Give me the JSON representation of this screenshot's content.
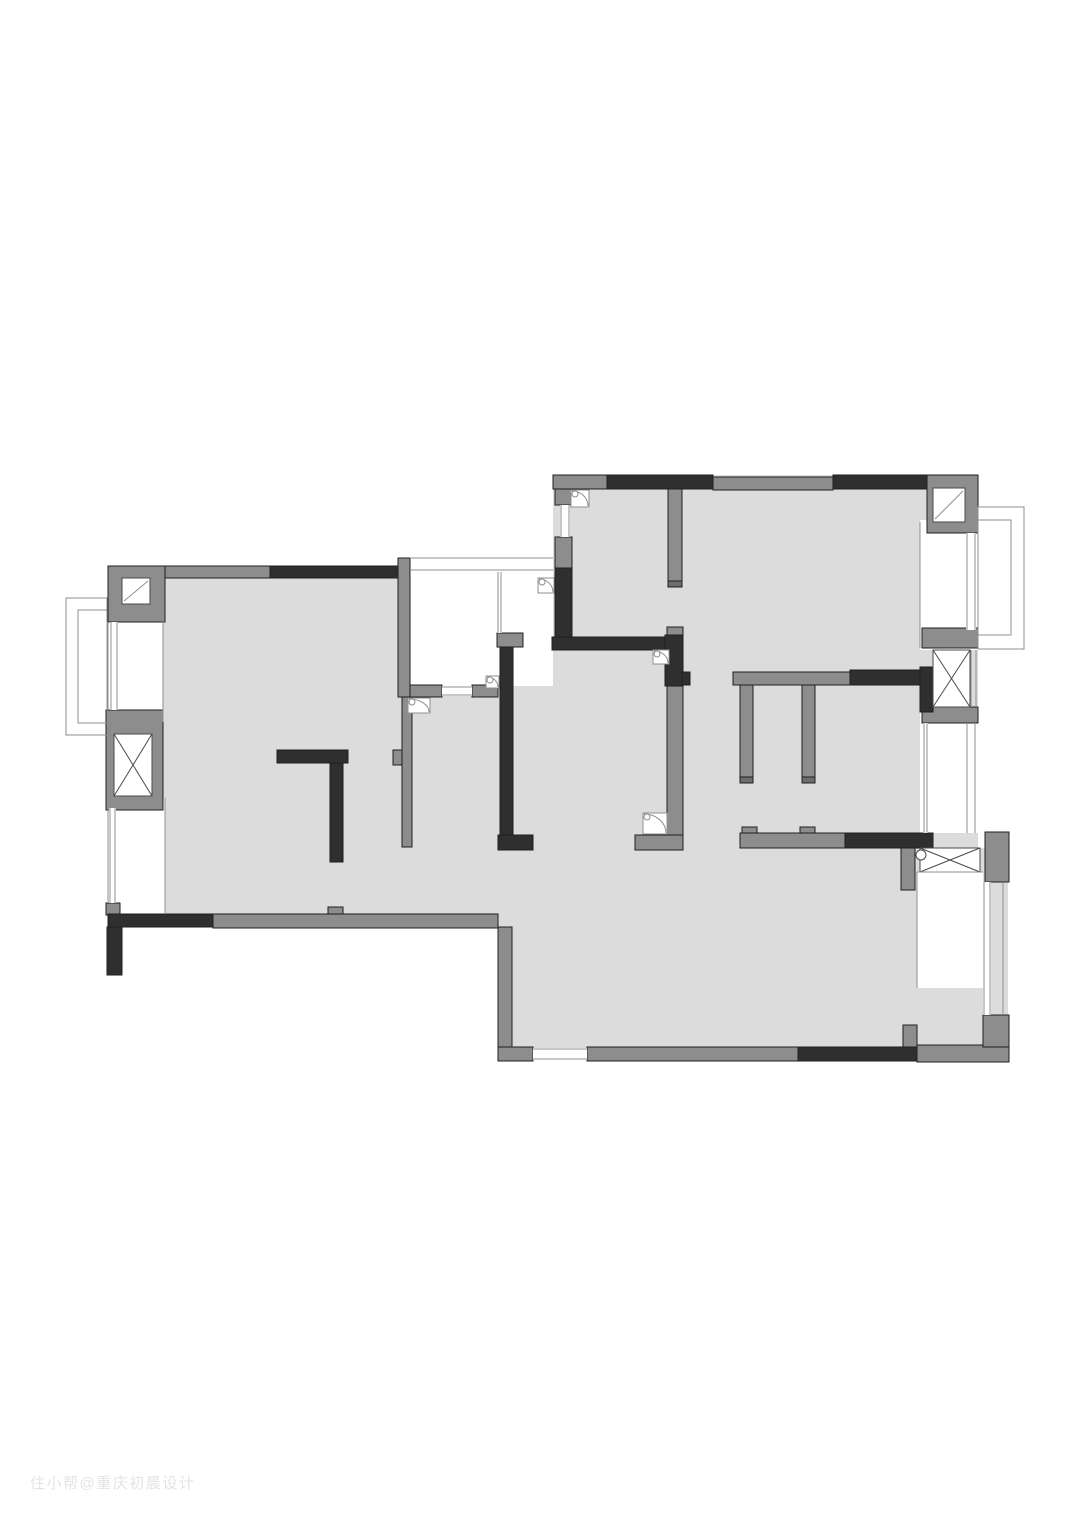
{
  "watermark": {
    "text": "住小帮@重庆初晨设计"
  },
  "plan": {
    "palette": {
      "floor": "#dcdcdd",
      "wall_gray": "#8d8d8d",
      "wall_dark": "#2f2f2f",
      "wall_cap": "#6d6d6d",
      "outline": "#1f1f1f",
      "thin": "#8f8f8f",
      "hatch": "#4a4a4a"
    },
    "floors": [
      [
        163,
        578,
        239,
        336
      ],
      [
        402,
        685,
        151,
        243
      ],
      [
        553,
        475,
        425,
        373
      ],
      [
        498,
        848,
        510,
        212
      ]
    ],
    "white_areas": [
      [
        410,
        556,
        143,
        130
      ],
      [
        108,
        600,
        55,
        122
      ],
      [
        108,
        798,
        57,
        118
      ],
      [
        920,
        520,
        58,
        130
      ],
      [
        920,
        710,
        60,
        123
      ],
      [
        917,
        872,
        66,
        116
      ]
    ],
    "gray_walls": [
      [
        108,
        566,
        162,
        12
      ],
      [
        108,
        566,
        57,
        56
      ],
      [
        106,
        710,
        57,
        100
      ],
      [
        106,
        903,
        14,
        12
      ],
      [
        213,
        914,
        285,
        14
      ],
      [
        328,
        907,
        15,
        7
      ],
      [
        498,
        927,
        14,
        133
      ],
      [
        498,
        1047,
        35,
        14
      ],
      [
        587,
        1047,
        211,
        14
      ],
      [
        917,
        1045,
        92,
        17
      ],
      [
        983,
        1015,
        26,
        32
      ],
      [
        903,
        1025,
        14,
        22
      ],
      [
        398,
        558,
        12,
        139
      ],
      [
        402,
        697,
        10,
        150
      ],
      [
        393,
        750,
        9,
        15
      ],
      [
        410,
        685,
        32,
        12
      ],
      [
        472,
        685,
        26,
        12
      ],
      [
        497,
        633,
        26,
        14
      ],
      [
        553,
        475,
        57,
        14
      ],
      [
        555,
        489,
        17,
        16
      ],
      [
        555,
        537,
        17,
        31
      ],
      [
        713,
        477,
        120,
        13
      ],
      [
        927,
        475,
        51,
        58
      ],
      [
        668,
        487,
        14,
        100
      ],
      [
        667,
        627,
        16,
        8
      ],
      [
        667,
        686,
        16,
        149
      ],
      [
        635,
        835,
        48,
        15
      ],
      [
        733,
        672,
        117,
        13
      ],
      [
        740,
        685,
        13,
        98
      ],
      [
        802,
        685,
        13,
        98
      ],
      [
        742,
        827,
        15,
        6
      ],
      [
        800,
        827,
        15,
        6
      ],
      [
        922,
        628,
        56,
        20
      ],
      [
        922,
        707,
        56,
        16
      ],
      [
        985,
        832,
        24,
        50
      ],
      [
        901,
        847,
        14,
        43
      ],
      [
        740,
        833,
        105,
        15
      ]
    ],
    "dark_walls": [
      [
        270,
        566,
        128,
        12
      ],
      [
        607,
        475,
        106,
        14
      ],
      [
        833,
        475,
        94,
        14
      ],
      [
        555,
        568,
        17,
        70
      ],
      [
        552,
        637,
        131,
        13
      ],
      [
        665,
        635,
        18,
        51
      ],
      [
        682,
        672,
        8,
        13
      ],
      [
        500,
        647,
        13,
        193
      ],
      [
        498,
        835,
        35,
        15
      ],
      [
        277,
        750,
        71,
        13
      ],
      [
        330,
        763,
        13,
        99
      ],
      [
        108,
        914,
        105,
        13
      ],
      [
        107,
        927,
        15,
        48
      ],
      [
        850,
        670,
        72,
        15
      ],
      [
        920,
        667,
        13,
        45
      ],
      [
        845,
        833,
        88,
        15
      ],
      [
        798,
        1047,
        119,
        14
      ]
    ],
    "caps": [
      [
        668,
        581,
        14,
        6
      ],
      [
        740,
        777,
        13,
        6
      ],
      [
        802,
        777,
        13,
        6
      ]
    ],
    "hatch_boxes": [
      [
        114,
        734,
        38,
        62
      ],
      [
        933,
        650,
        37,
        57
      ],
      [
        920,
        848,
        60,
        24
      ]
    ],
    "corner_windows": [
      [
        122,
        578,
        28,
        26
      ],
      [
        933,
        488,
        32,
        34
      ]
    ],
    "windows": [
      {
        "r": [
          110,
          622,
          8,
          88
        ],
        "o": "v"
      },
      {
        "r": [
          109,
          808,
          7,
          95
        ],
        "o": "v"
      },
      {
        "r": [
          442,
          686,
          30,
          10
        ],
        "o": "h"
      },
      {
        "r": [
          560,
          505,
          10,
          32
        ],
        "o": "v"
      },
      {
        "r": [
          966,
          533,
          10,
          97
        ],
        "o": "v"
      },
      {
        "r": [
          923,
          723,
          5,
          110
        ],
        "o": "v"
      },
      {
        "r": [
          983,
          882,
          8,
          133
        ],
        "o": "v"
      },
      {
        "r": [
          533,
          1048,
          54,
          12
        ],
        "o": "h"
      },
      {
        "r": [
          497,
          572,
          5,
          61
        ],
        "o": "v"
      }
    ],
    "thin_lines": [
      [
        410,
        558,
        553,
        558
      ],
      [
        410,
        570,
        553,
        570
      ],
      [
        163,
        600,
        163,
        722
      ],
      [
        165,
        798,
        165,
        914
      ],
      [
        920,
        522,
        920,
        648
      ],
      [
        967,
        723,
        967,
        833
      ],
      [
        975,
        723,
        975,
        833
      ],
      [
        917,
        872,
        983,
        872
      ],
      [
        917,
        872,
        917,
        988
      ],
      [
        1003,
        882,
        1003,
        1015
      ],
      [
        971,
        650,
        971,
        707
      ],
      [
        976,
        650,
        976,
        707
      ],
      [
        108,
        622,
        108,
        710
      ],
      [
        108,
        808,
        108,
        903
      ]
    ],
    "balconies": [
      {
        "outer": [
          66,
          598,
          41,
          137
        ],
        "inner": [
          78,
          610,
          29,
          113
        ]
      },
      {
        "outer": [
          978,
          507,
          46,
          142
        ],
        "inner": [
          978,
          520,
          33,
          115
        ]
      }
    ],
    "door_arcs": [
      [
        571,
        490,
        18,
        17
      ],
      [
        538,
        578,
        16,
        15
      ],
      [
        653,
        650,
        16,
        14
      ],
      [
        408,
        698,
        22,
        15
      ],
      [
        486,
        676,
        13,
        12
      ],
      [
        643,
        813,
        24,
        21
      ]
    ],
    "door_circle": [
      921,
      855,
      5
    ]
  }
}
